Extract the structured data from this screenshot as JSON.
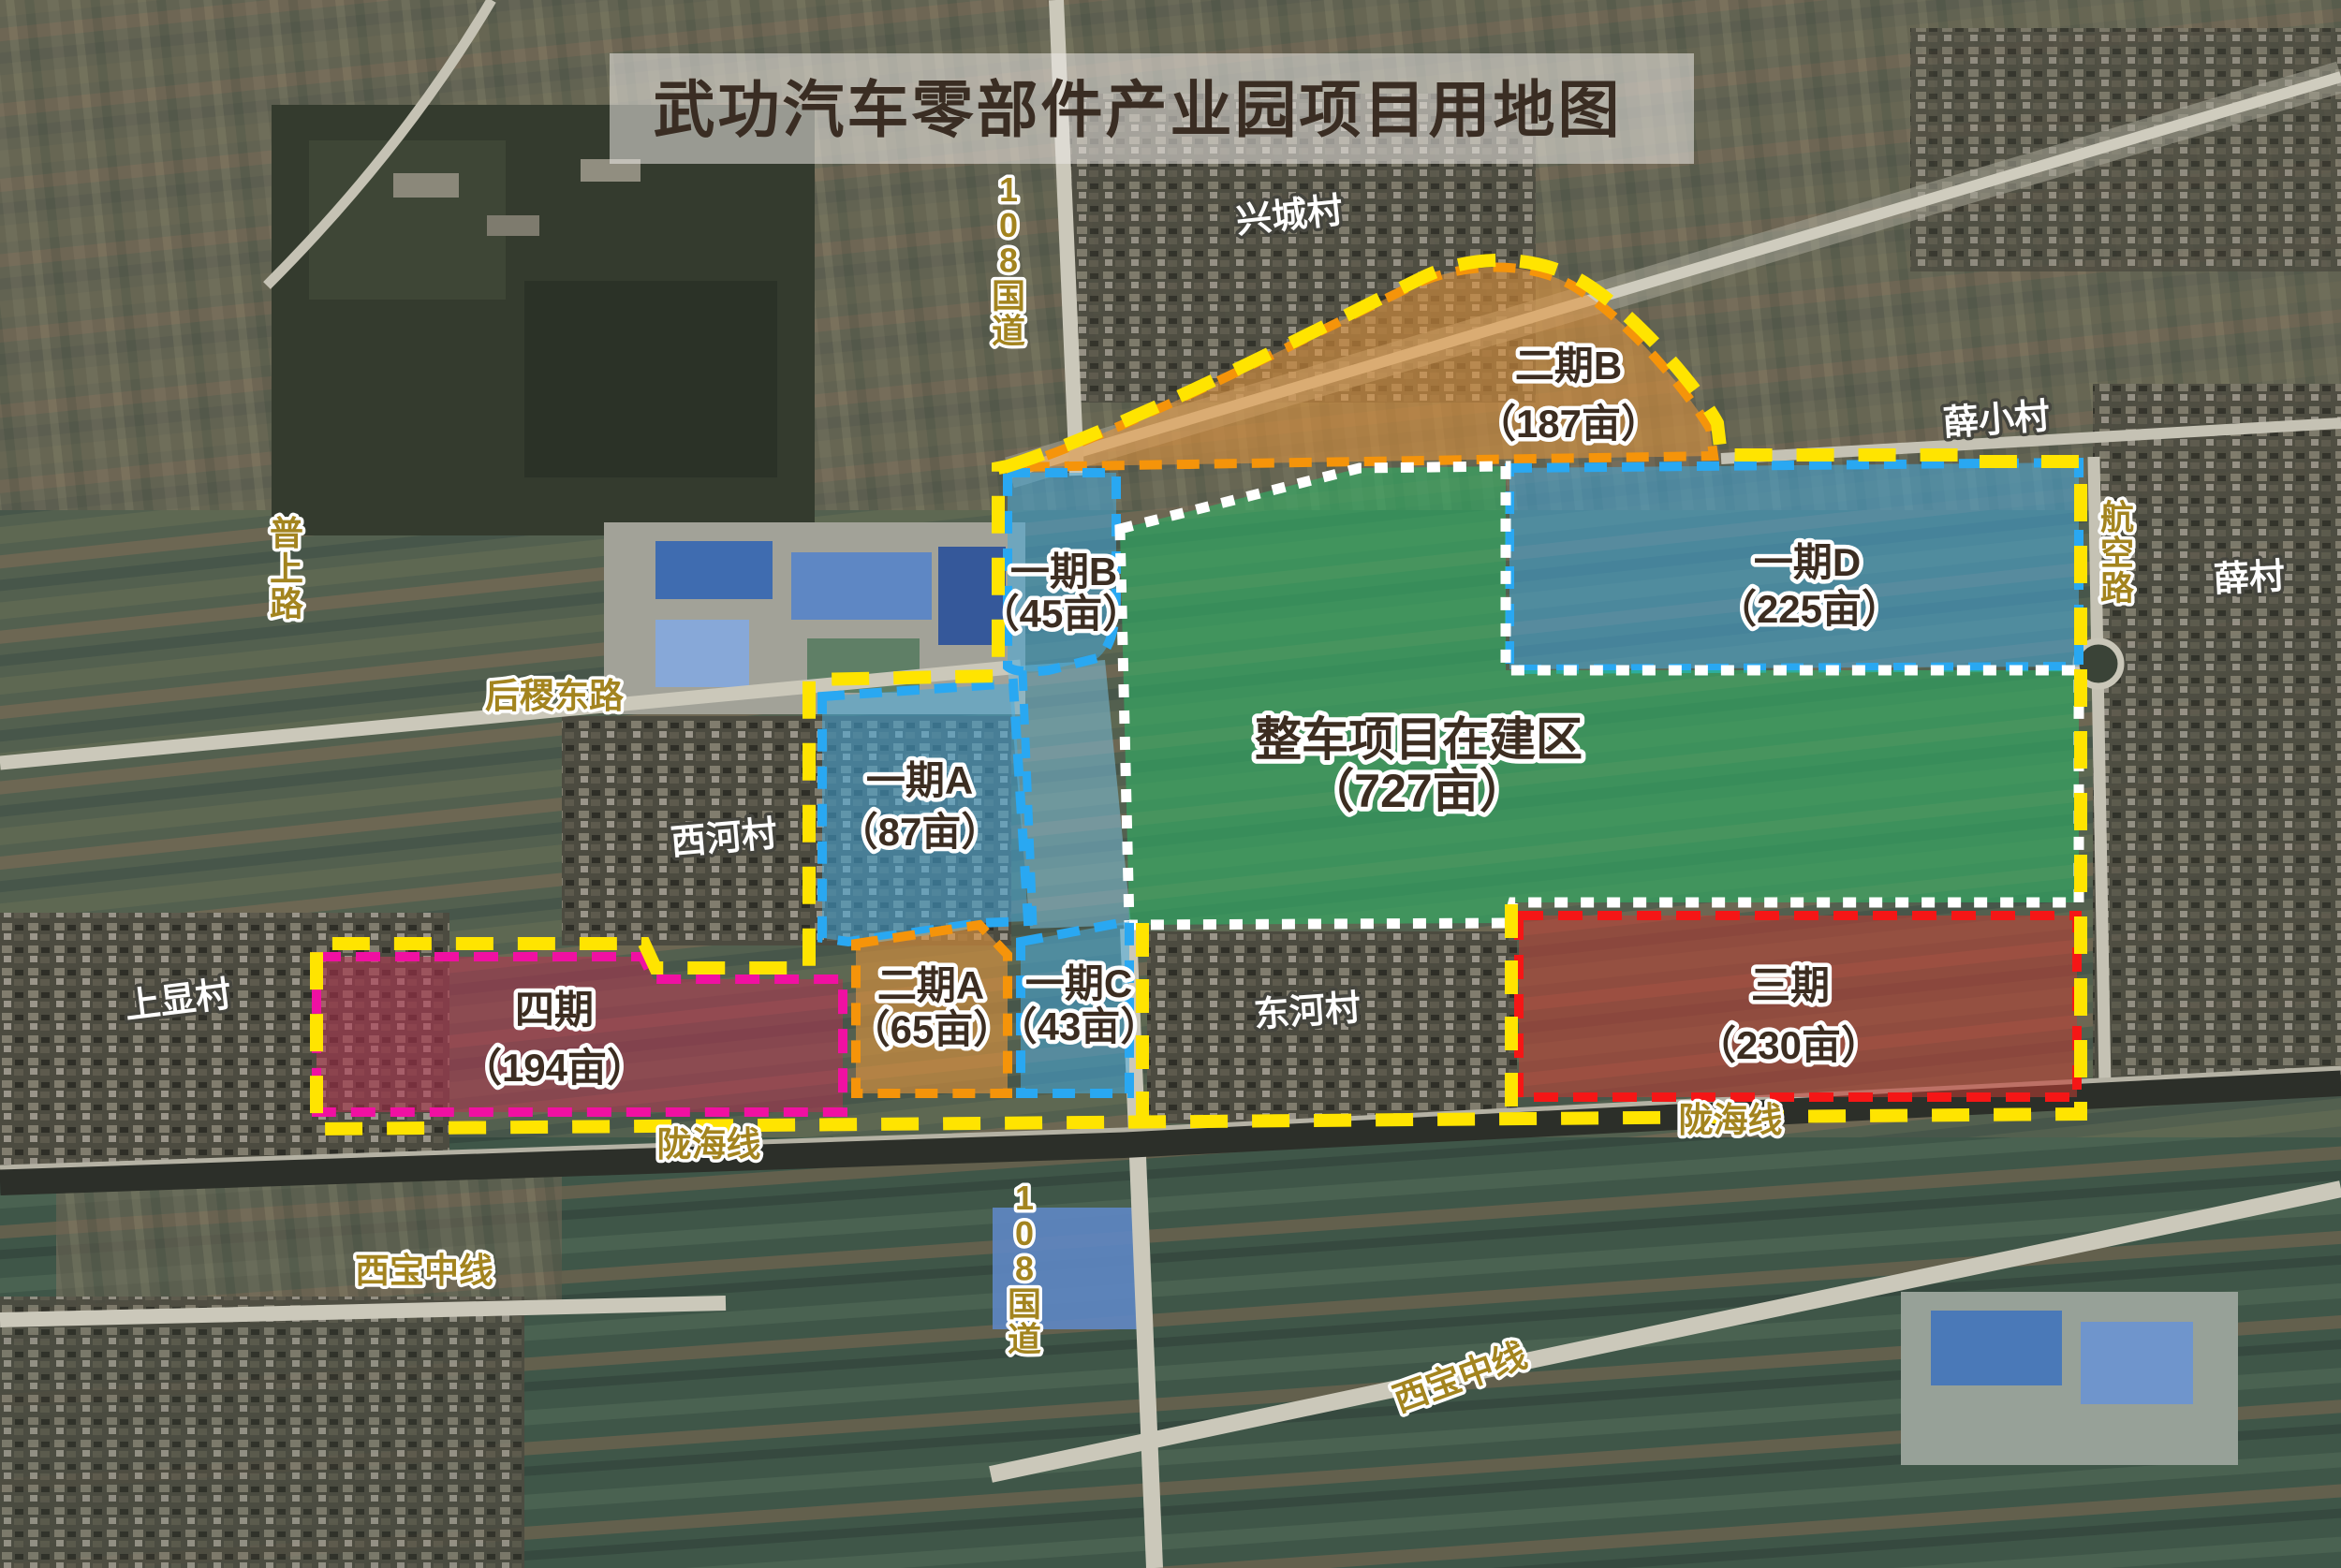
{
  "title": "武功汽车零部件产业园项目用地图",
  "zones": {
    "phase1a": {
      "name": "一期A",
      "area": "（87亩）"
    },
    "phase1b": {
      "name": "一期B",
      "area": "（45亩）"
    },
    "phase1c": {
      "name": "一期C",
      "area": "（43亩）"
    },
    "phase1d": {
      "name": "一期D",
      "area": "（225亩）"
    },
    "phase2a": {
      "name": "二期A",
      "area": "（65亩）"
    },
    "phase2b": {
      "name": "二期B",
      "area": "（187亩）"
    },
    "phase3": {
      "name": "三期",
      "area": "（230亩）"
    },
    "phase4": {
      "name": "四期",
      "area": "（194亩）"
    },
    "vehicle": {
      "name": "整车项目在建区",
      "area": "（727亩）"
    }
  },
  "roads": {
    "g108_north": "108国道",
    "g108_south": "108国道",
    "pushang": "普上路",
    "houji_east": "后稷东路",
    "hangkong": "航空路",
    "longhai_west": "陇海线",
    "longhai_east": "陇海线",
    "xibao_west": "西宝中线",
    "xibao_east": "西宝中线"
  },
  "villages": {
    "xingcheng": "兴城村",
    "xuexiao": "薛小村",
    "xuecun": "薛村",
    "xihe": "西河村",
    "donghe": "东河村",
    "shangxian": "上显村"
  },
  "colors": {
    "boundary_yellow": "#ffe400",
    "blue_border": "#29a8f2",
    "blue_fill": "#45a9dd",
    "corridor_fill": "#7fc8e8",
    "green_border": "#ffffff",
    "green_fill": "#2eb266",
    "orange_border": "#f5940a",
    "orange_fill": "#e2953c",
    "magenta_border": "#f010a2",
    "crimson_fill": "#b23350",
    "red_border": "#f51616",
    "red_fill": "#c23c33",
    "road_label_gold": "#a3841f",
    "title_bar": "#eceae6"
  }
}
